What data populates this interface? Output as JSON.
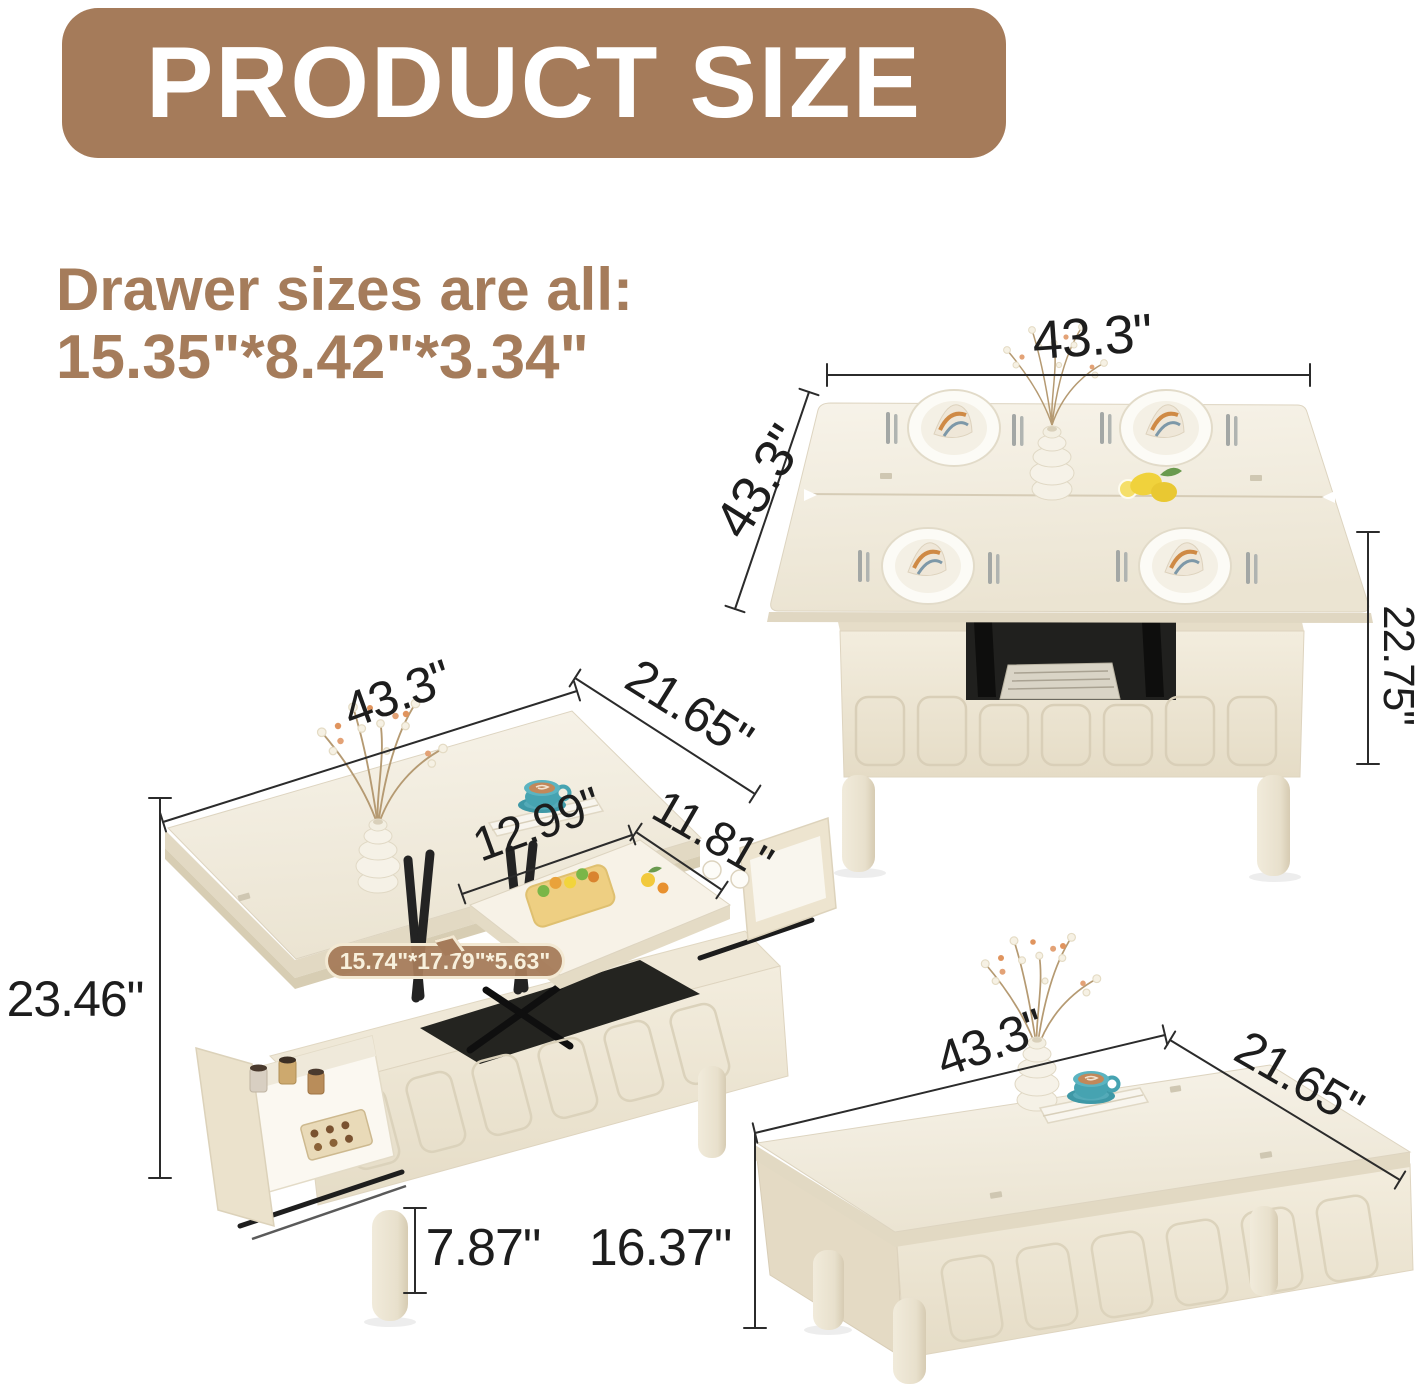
{
  "banner": {
    "title": "PRODUCT SIZE"
  },
  "note": {
    "line1": "Drawer sizes are all:",
    "line2": "15.35\"*8.42\"*3.34\""
  },
  "figures": {
    "dining": {
      "label": "lift-top table fully opened as square dining table",
      "width": "43.3\"",
      "depth": "43.3\"",
      "height": "22.75\""
    },
    "lift": {
      "label": "lift-top raised with open storage drawers",
      "width": "43.3\"",
      "depth": "21.65\"",
      "lift_width": "12.99\"",
      "lift_depth": "11.81\"",
      "storage_size": "15.74\"*17.79\"*5.63\"",
      "total_height": "23.46\"",
      "leg_height": "7.87\""
    },
    "closed": {
      "label": "closed coffee table",
      "width": "43.3\"",
      "depth": "21.65\"",
      "height": "16.37\""
    }
  },
  "colors": {
    "banner_bg": "#a57b5a",
    "note_text": "#a57c5b",
    "dimension_text": "#1d1d1d",
    "table_cream": "#f2ecdd",
    "table_edge": "#e0d7c2",
    "mechanism_black": "#232323",
    "accent_teal": "#46a3b1",
    "storage_pill_bg": "#a57b5a",
    "storage_pill_text": "#f8f0dc"
  }
}
